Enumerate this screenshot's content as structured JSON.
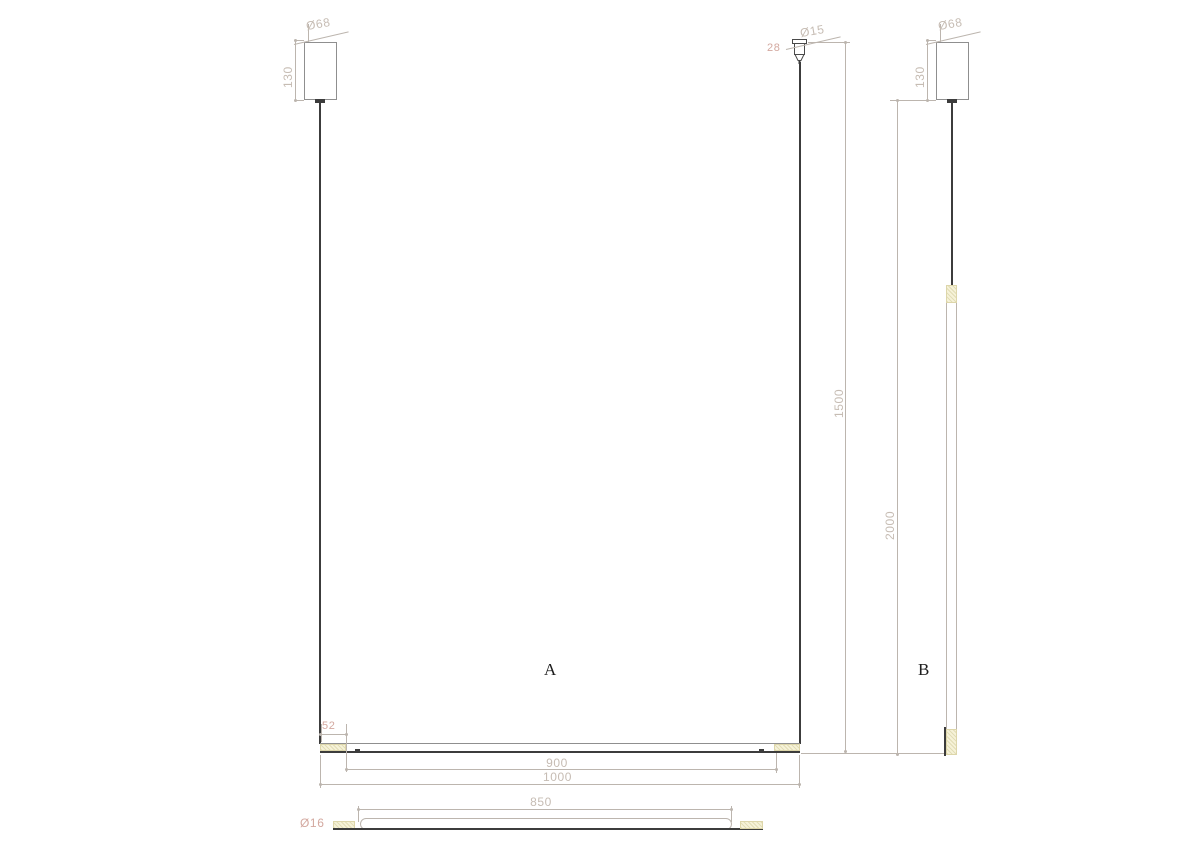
{
  "colors": {
    "background": "#ffffff",
    "dim_text": "#c6bcb3",
    "dim_text_accent": "#d3a89f",
    "dim_line": "#bcb5ae",
    "outline": "#8f8f8f",
    "dark_line": "#3c3c3c",
    "cap_fill": "#f6f2d8",
    "cap_border": "#ddd6aa",
    "view_label": "#1d1d1d"
  },
  "drawing": {
    "view_a": {
      "label": "A",
      "canopy_diameter": "Ø68",
      "canopy_height": "130",
      "grip_diameter": "Ø15",
      "grip_height": "28",
      "suspension_length": "1500",
      "end_cap_length": "52",
      "suspension_span": "900",
      "fixture_length": "1000"
    },
    "view_b": {
      "label": "B",
      "canopy_diameter": "Ø68",
      "canopy_height": "130",
      "overall_drop": "2000"
    },
    "detail_view": {
      "tube_diameter": "Ø16",
      "tube_length": "850"
    }
  }
}
